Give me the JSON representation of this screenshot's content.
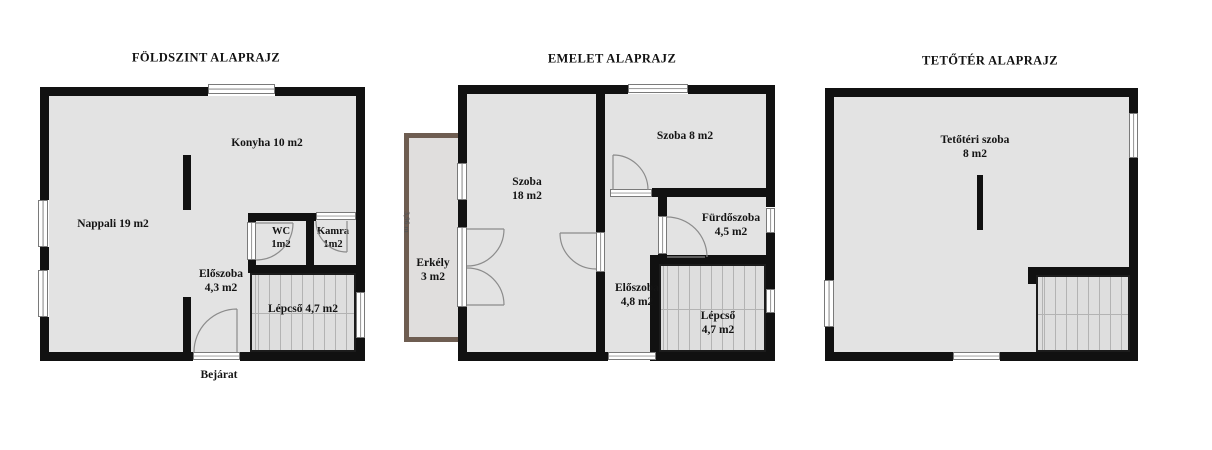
{
  "colors": {
    "wall": "#111111",
    "floor": "#e3e3e3",
    "balcony_wall": "#6e5d51",
    "background": "#ffffff"
  },
  "plans": {
    "ground": {
      "title": "FÖLDSZINT ALAPRAJZ",
      "rooms": {
        "konyha": {
          "label": "Konyha 10 m2"
        },
        "nappali": {
          "label": "Nappali 19 m2"
        },
        "wc": {
          "line1": "WC",
          "line2": "1m2"
        },
        "kamra": {
          "line1": "Kamra",
          "line2": "1m2"
        },
        "eloszoba": {
          "line1": "Előszoba",
          "line2": "4,3 m2"
        },
        "lepcso": {
          "label": "Lépcső 4,7 m2"
        }
      },
      "entrance_label": "Bejárat"
    },
    "floor1": {
      "title": "EMELET ALAPRAJZ",
      "rooms": {
        "szoba18": {
          "line1": "Szoba",
          "line2": "18 m2"
        },
        "szoba8": {
          "label": "Szoba 8 m2"
        },
        "furdoszoba": {
          "line1": "Fürdőszoba",
          "line2": "4,5 m2"
        },
        "eloszoba": {
          "line1": "Előszoba",
          "line2": "4,8 m2"
        },
        "lepcso": {
          "line1": "Lépcső",
          "line2": "4,7 m2"
        },
        "erkely": {
          "line1": "Erkély",
          "line2": "3 m2"
        }
      },
      "balcony_dimension": "3,96 m"
    },
    "attic": {
      "title": "TETŐTÉR ALAPRAJZ",
      "rooms": {
        "tetoteri": {
          "line1": "Tetőtéri szoba",
          "line2": "8 m2"
        }
      }
    }
  }
}
